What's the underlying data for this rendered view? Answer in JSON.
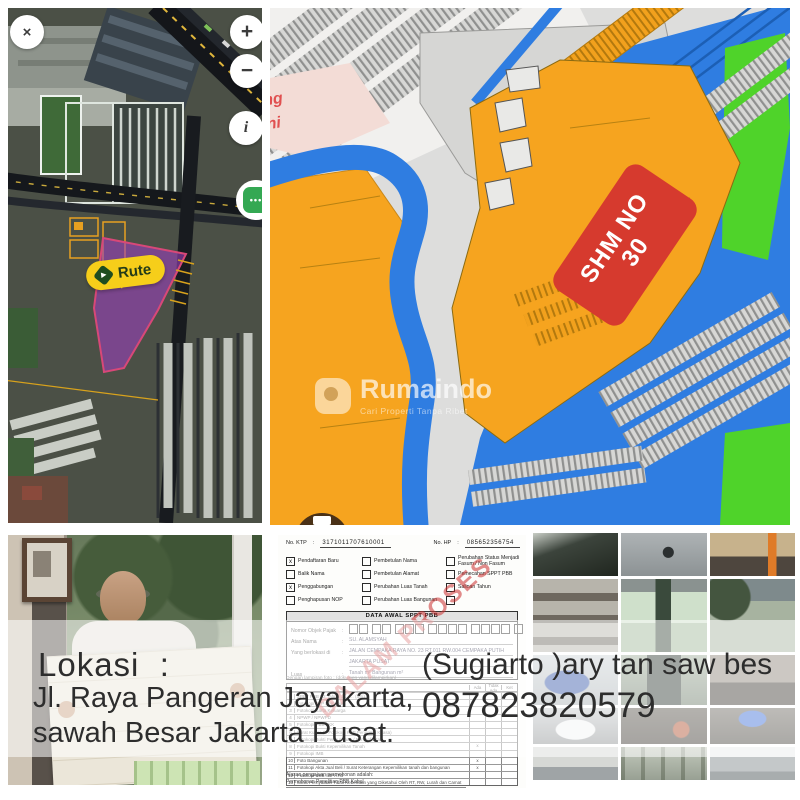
{
  "brand": {
    "name": "Rumaindo",
    "tagline": "Cari Properti Tanpa Ribet"
  },
  "satellite_map": {
    "close": "×",
    "zoom_in": "+",
    "zoom_out": "−",
    "info": "i",
    "more": "•••",
    "route_label": "Rute",
    "route_icon_glyph": "▶"
  },
  "cadastral_map": {
    "parcel_label_line1": "SHM NO",
    "parcel_label_line2": "30",
    "edge_label_1": "ng",
    "edge_label_2": "ni"
  },
  "overlay": {
    "lokasi": "Lokasi  :",
    "address1": "Jl. Raya Pangeran Jayakarta,",
    "address2": "sawah Besar Jakarta Pusat.",
    "contact": "(Sugiarto )ary tan saw bes",
    "phone": "087823820579"
  },
  "form": {
    "colon": ":",
    "no_ktp_label": "No. KTP",
    "no_ktp_value": "3171011707610001",
    "no_hp_label": "No. HP",
    "no_hp_value": "085652356754",
    "check_glyph": "x",
    "checkboxes": [
      {
        "label": "Pendaftaran Baru",
        "checked": true
      },
      {
        "label": "Pembetulan Nama",
        "checked": false
      },
      {
        "label": "Perubahan Status Menjadi Fasum / Non Fasum",
        "checked": false
      },
      {
        "label": "Balik Nama",
        "checked": false
      },
      {
        "label": "Pembetulan Alamat",
        "checked": false
      },
      {
        "label": "Pemecahan SPPT PBB",
        "checked": false
      },
      {
        "label": "Penggabungan",
        "checked": true
      },
      {
        "label": "Perubahan Luas Tanah",
        "checked": false
      },
      {
        "label": "Salinan Tahun",
        "checked": false
      },
      {
        "label": "Penghapusan NOP",
        "checked": false
      },
      {
        "label": "Perubahan Luas Bangunan",
        "checked": false
      },
      {
        "label": "",
        "checked": false
      }
    ],
    "table_title": "DATA AWAL SPPT PBB",
    "nop_groups": [
      2,
      2,
      3,
      4,
      4,
      1
    ],
    "fields": [
      {
        "label": "Nomor Objek Pajak",
        "value": "",
        "boxes": true
      },
      {
        "label": "Atas Nama",
        "value": "SU. ALAMSYAH"
      },
      {
        "label": "Yang berlokasi di",
        "value": "JALAN CEMPAKA RAYA NO. 23 RT.011 RW.004 CEMPAKA PUTIH"
      },
      {
        "label": "",
        "value": "JAKARTA PUSAT"
      },
      {
        "label": "Luas",
        "value": "Tanah          m²          Bangunan          m²"
      }
    ],
    "attachment_note": "Dengan lampiran foto : (dokumen yang dilampirkan)",
    "columns": [
      "Ada",
      "Tidak Ada",
      "Ket"
    ],
    "checklist": [
      {
        "text": "SPPT PBB P2 Tahun ……… (asli)",
        "ada": ""
      },
      {
        "text": "Fotokopi KTP Pemohon",
        "ada": ""
      },
      {
        "text": "Fotokopi Kartu Keluarga",
        "ada": ""
      },
      {
        "text": "NPWP / NPWPD",
        "ada": ""
      },
      {
        "text": "Fotokopi PBB / KK",
        "ada": ""
      },
      {
        "text": "Surat Kuasa (+ Fotokopi KTP Penerima Kuasa)",
        "ada": ""
      },
      {
        "text": "Fotokopi Bukti Penguasaan / Pemanfaatan",
        "ada": ""
      },
      {
        "text": "Fotokopi Bukti Kepemilikan Tanah",
        "ada": "x"
      },
      {
        "text": "Fotokopi IMB",
        "ada": ""
      },
      {
        "text": "Foto Bangunan",
        "ada": "x"
      },
      {
        "text": "Fotokopi Akta Jual Beli / Surat Keterangan Kepemilikan tanah dan bangunan",
        "ada": "x"
      },
      {
        "text": "Fotokopi SSB / BPHTB",
        "ada": ""
      },
      {
        "text": "Surat Pernyataan Tidak Keberatan yang Diketahui Oleh RT, RW, Lurah dan Camat",
        "ada": ""
      }
    ],
    "reason_label": "Alasan pengajuan permohonan adalah:",
    "reason_value": "Permohonan Penelitian PBB Kabul",
    "watermark": "DALAM PROSES"
  },
  "colors": {
    "zone_orange": "#f6a41f",
    "road_blue": "#2f7de1",
    "zone_green": "#4fd32a",
    "certificate_red": "#d63a2e",
    "route_yellow": "#f6ce1a",
    "parcel_purple": "#9c40c0"
  }
}
